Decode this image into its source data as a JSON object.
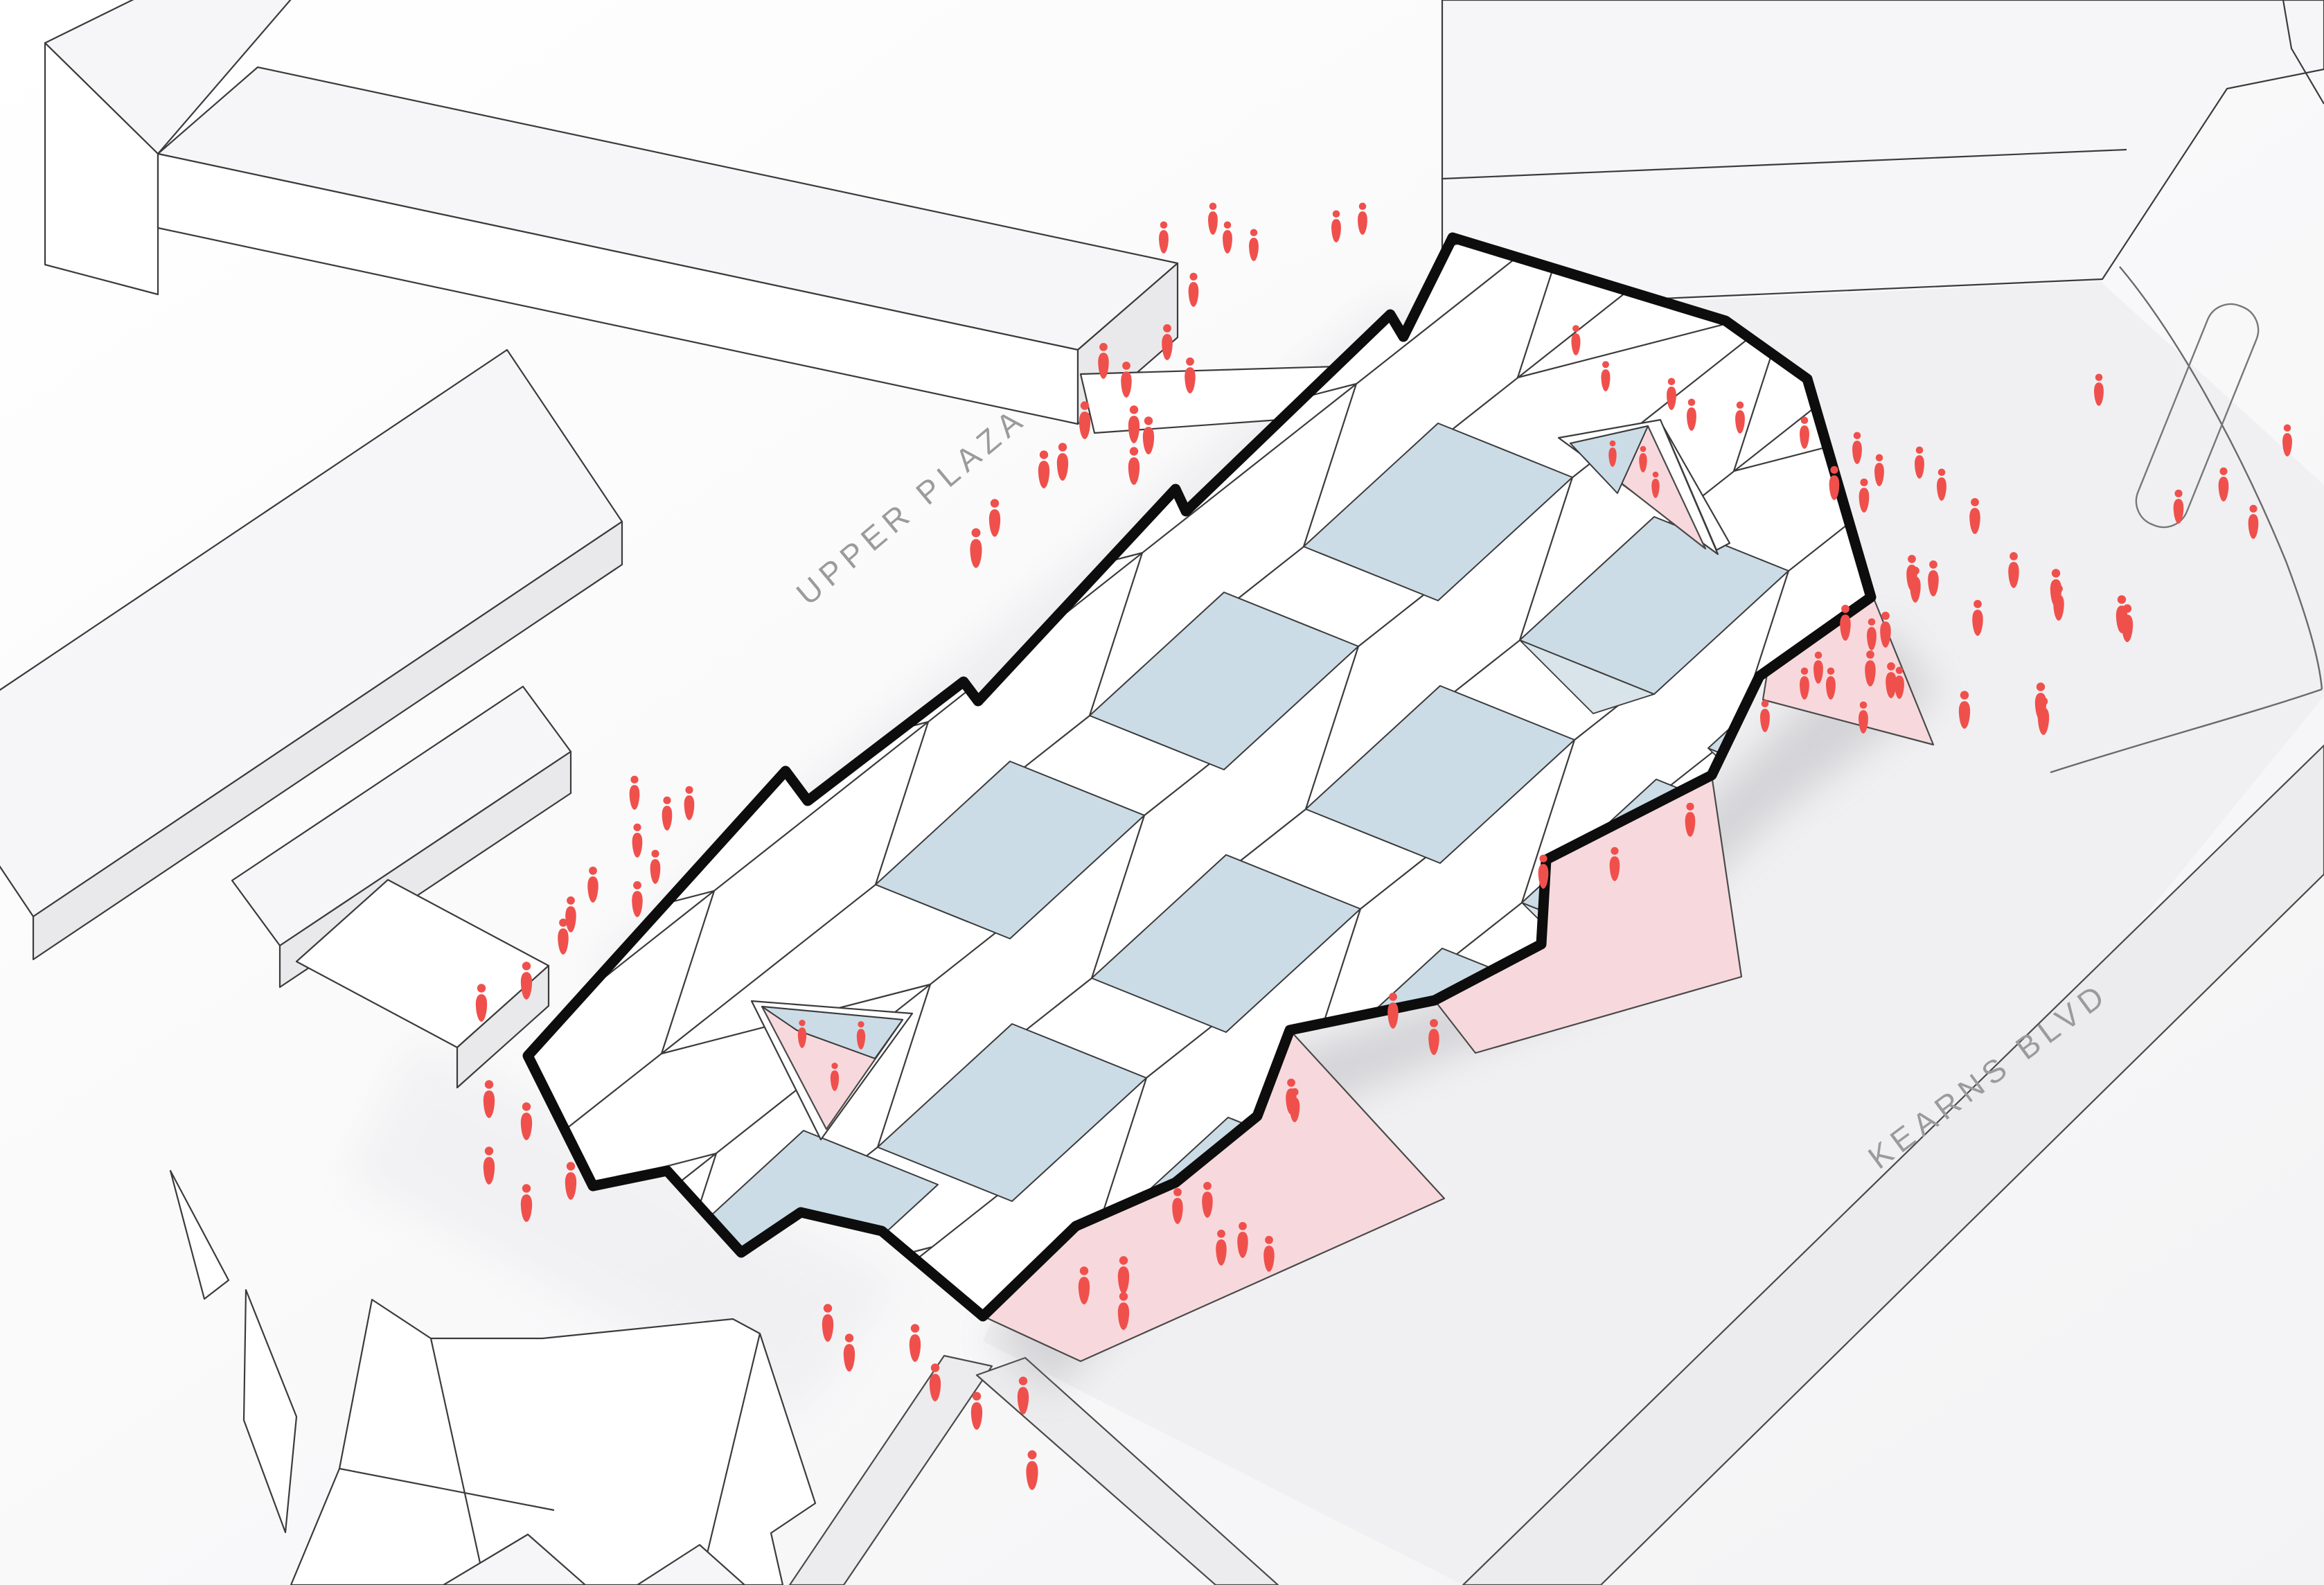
{
  "labels": {
    "upper_plaza": "UPPER PLAZA",
    "kearns_blvd": "KEARNS BLVD"
  },
  "colors": {
    "bg": "#fbfbfc",
    "ground": "#f0f0f2",
    "road": "#ececee",
    "slab_top": "#f6f6f8",
    "slab_face": "#ffffff",
    "slab_side": "#e9e9eb",
    "thin_line": "#3b3b3b",
    "outline": "#0d0d0d",
    "skylight_blue": "#cbdce6",
    "wall_blue": "#d9e3ea",
    "pink": "#f7d9dd",
    "pink_edge": "#4a4a4a",
    "people_red": "#f0504c",
    "label_gray": "#9b9b9b",
    "shadow": "#8a8a92"
  },
  "people": {
    "icon": "person-icon",
    "groups": [
      {
        "name": "upper-plaza-walk",
        "positions": [
          [
            1680,
            349,
            0.85
          ],
          [
            1751,
            322,
            0.85
          ],
          [
            1772,
            349,
            0.85
          ],
          [
            1810,
            360,
            0.85
          ],
          [
            1929,
            333,
            0.85
          ],
          [
            1967,
            322,
            0.85
          ],
          [
            1723,
            425,
            0.9
          ],
          [
            1685,
            501,
            0.95
          ],
          [
            1593,
            528,
            0.95
          ],
          [
            1626,
            555,
            0.95
          ],
          [
            1718,
            549,
            0.95
          ],
          [
            1566,
            614,
            1
          ],
          [
            1637,
            620,
            1
          ],
          [
            1658,
            636,
            1
          ],
          [
            1507,
            685,
            1
          ],
          [
            1534,
            674,
            1
          ],
          [
            1436,
            755,
            1
          ],
          [
            1409,
            799,
            1.05
          ],
          [
            1637,
            680,
            1
          ]
        ]
      },
      {
        "name": "right-plaza",
        "positions": [
          [
            2275,
            497,
            0.8
          ],
          [
            2318,
            549,
            0.8
          ],
          [
            2413,
            575,
            0.85
          ],
          [
            2442,
            605,
            0.85
          ],
          [
            2512,
            609,
            0.85
          ],
          [
            2605,
            631,
            0.85
          ],
          [
            2648,
            704,
            0.9
          ],
          [
            2691,
            722,
            0.9
          ],
          [
            2681,
            653,
            0.85
          ],
          [
            2713,
            685,
            0.85
          ],
          [
            2771,
            674,
            0.85
          ],
          [
            2803,
            706,
            0.85
          ],
          [
            2722,
            916,
            0.95
          ],
          [
            2760,
            834,
            0.95
          ],
          [
            2791,
            842,
            0.95
          ],
          [
            2851,
            752,
            0.95
          ],
          [
            2907,
            830,
            0.95
          ],
          [
            2946,
            1020,
            1
          ],
          [
            3063,
            894,
            1
          ],
          [
            2968,
            856,
            1
          ],
          [
            2664,
            906,
            0.95
          ],
          [
            2700,
            972,
            0.95
          ],
          [
            2730,
            989,
            0.95
          ],
          [
            2836,
            1032,
            1
          ],
          [
            2855,
            899,
            0.95
          ],
          [
            2765,
            851,
            0.95
          ],
          [
            2950,
            1041,
            1
          ],
          [
            3071,
            907,
            1
          ],
          [
            2972,
            877,
            0.95
          ],
          [
            3030,
            569,
            0.85
          ],
          [
            3145,
            738,
            0.9
          ],
          [
            3210,
            706,
            0.9
          ],
          [
            3253,
            760,
            0.9
          ],
          [
            3302,
            642,
            0.85
          ]
        ]
      },
      {
        "name": "left-walk",
        "positions": [
          [
            916,
            1151,
            0.9
          ],
          [
            963,
            1181,
            0.9
          ],
          [
            995,
            1166,
            0.9
          ],
          [
            920,
            1220,
            0.9
          ],
          [
            946,
            1258,
            0.9
          ],
          [
            856,
            1284,
            0.95
          ],
          [
            824,
            1327,
            0.95
          ],
          [
            920,
            1305,
            0.95
          ],
          [
            813,
            1359,
            0.95
          ],
          [
            760,
            1423,
            1
          ],
          [
            695,
            1455,
            1
          ],
          [
            706,
            1594,
            1
          ],
          [
            760,
            1626,
            1
          ],
          [
            706,
            1690,
            1
          ],
          [
            824,
            1712,
            1
          ],
          [
            760,
            1744,
            1
          ]
        ]
      },
      {
        "name": "south-walk",
        "positions": [
          [
            1195,
            1917,
            1
          ],
          [
            1226,
            1960,
            1
          ],
          [
            1321,
            1946,
            1
          ],
          [
            1350,
            2003,
            1
          ],
          [
            1410,
            2044,
            1
          ],
          [
            1477,
            2022,
            1
          ],
          [
            1490,
            2130,
            1.05
          ]
        ]
      },
      {
        "name": "entry-right",
        "positions": [
          [
            2702,
            922,
            0.85
          ],
          [
            2742,
            992,
            0.85
          ],
          [
            2625,
            970,
            0.85
          ],
          [
            2643,
            993,
            0.85
          ],
          [
            2605,
            993,
            0.85
          ],
          [
            2548,
            1040,
            0.85
          ],
          [
            2690,
            1042,
            0.85
          ]
        ]
      },
      {
        "name": "entry-mid",
        "positions": [
          [
            2011,
            1466,
            0.95
          ],
          [
            2070,
            1504,
            0.95
          ],
          [
            2228,
            1265,
            0.9
          ],
          [
            2331,
            1254,
            0.9
          ],
          [
            1864,
            1590,
            0.95
          ],
          [
            2440,
            1190,
            0.9
          ]
        ]
      },
      {
        "name": "entry-south",
        "positions": [
          [
            1565,
            1863,
            1
          ],
          [
            1622,
            1848,
            1
          ],
          [
            1622,
            1900,
            1
          ],
          [
            1700,
            1748,
            0.95
          ],
          [
            1743,
            1739,
            0.95
          ],
          [
            1763,
            1808,
            0.95
          ],
          [
            1794,
            1797,
            0.95
          ],
          [
            1832,
            1817,
            0.95
          ],
          [
            1869,
            1602,
            0.9
          ]
        ]
      },
      {
        "name": "courtyard-upper",
        "positions": [
          [
            2328,
            660,
            0.7
          ],
          [
            2372,
            668,
            0.7
          ],
          [
            2390,
            705,
            0.7
          ]
        ]
      },
      {
        "name": "courtyard-lower",
        "positions": [
          [
            1158,
            1498,
            0.75
          ],
          [
            1243,
            1500,
            0.75
          ],
          [
            1205,
            1560,
            0.75
          ]
        ]
      }
    ]
  }
}
